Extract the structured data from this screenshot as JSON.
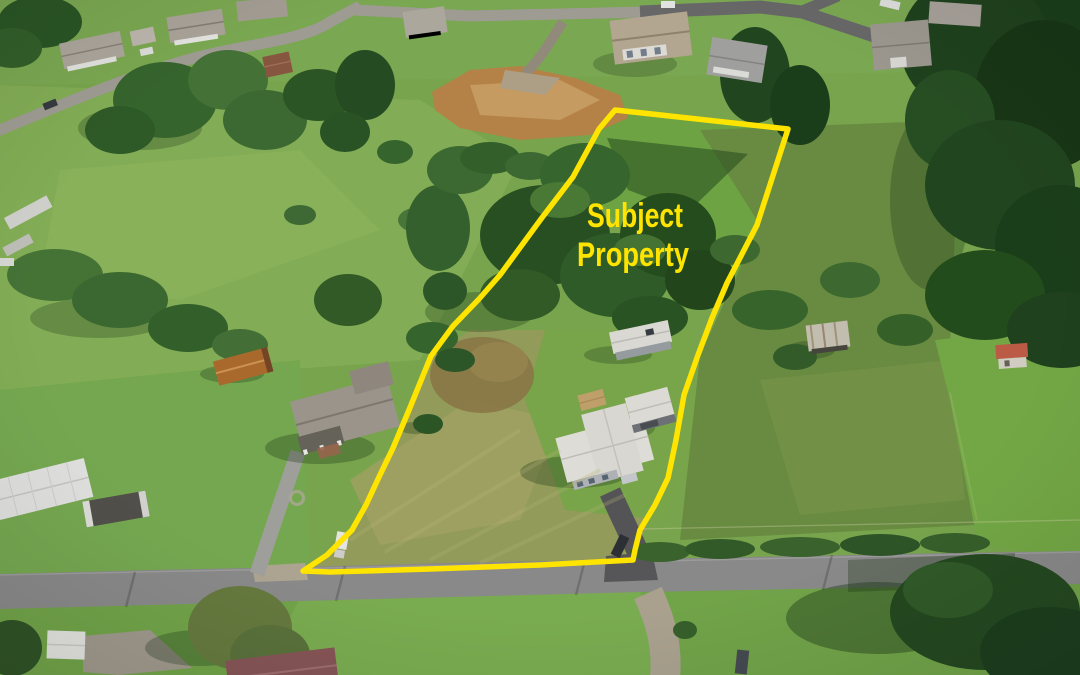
{
  "image": {
    "kind": "aerial-drone-photograph",
    "subject": "rural residential parcel outlined in yellow",
    "width_px": 1080,
    "height_px": 675
  },
  "annotation": {
    "label": {
      "line1": "Subject",
      "line2": "Property"
    },
    "label_color": "#ffe400",
    "boundary_color": "#ffe400",
    "boundary_stroke_width": "5.5",
    "boundary_points": "615,110 788,129 757,225 727,283 712,318 698,355 684,395 676,440 668,478 655,505 640,530 635,550 633,560 540,565 430,569 330,572 303,571 327,555 352,530 366,505 379,477 393,448 409,410 431,356 453,326 479,299 500,275 541,219 573,177 599,129"
  },
  "palette": {
    "lawn_green": "#77ad4c",
    "meadow_green": "#7fae52",
    "rough_field": "#9ba45f",
    "scrub_pasture": "#6f9445",
    "brush_dark": "#2e5827",
    "forest_evergreen": "#1c3e1b",
    "road_gray": "#8f8f8f",
    "asphalt_dark": "#5c5c5e",
    "dirt_brown": "#bf8a4c",
    "roof_white": "#ebe9e3",
    "roof_gray": "#a39d93",
    "roof_rust": "#b4702f",
    "roof_red": "#c6604a"
  },
  "scene_objects": [
    "subject-house",
    "subject-garage",
    "subject-shed",
    "subject-driveway",
    "neighbor-house",
    "neighbor-barn",
    "old-trailer",
    "red-roof-shed",
    "neighborhood-houses",
    "main-road",
    "dirt-construction-site",
    "evergreen-forest",
    "tree-clusters",
    "white-truck",
    "dark-suv"
  ]
}
